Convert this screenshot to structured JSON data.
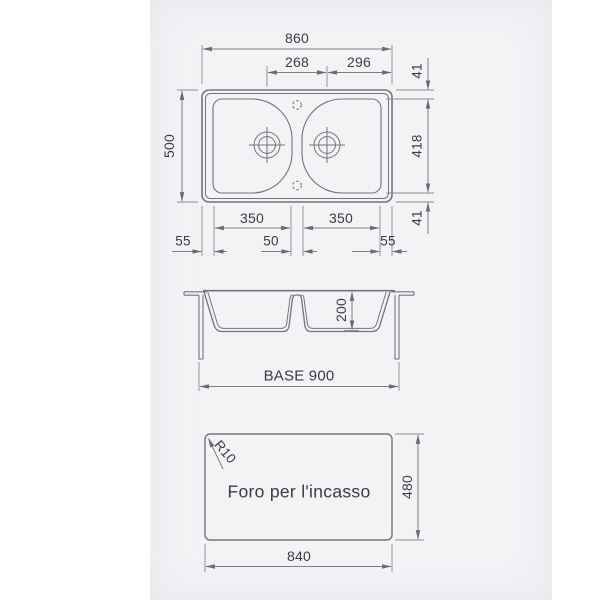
{
  "top_view": {
    "overall_width": "860",
    "drain_spacing": "268",
    "drain_to_edge": "296",
    "overall_depth": "500",
    "rim_top": "41",
    "bowl_span": "418",
    "rim_bottom": "41",
    "bowl_left_width": "350",
    "bowl_right_width": "350",
    "left_margin": "55",
    "center_gap": "50",
    "right_margin": "55"
  },
  "section_view": {
    "bowl_depth": "200",
    "base_label": "BASE 900"
  },
  "cutout_view": {
    "corner_radius": "R10",
    "caption": "Foro per l'incasso",
    "cut_width": "840",
    "cut_height": "480"
  },
  "colors": {
    "paper": "#f2f3f5",
    "margin": "#ffffff",
    "line": "#7e7e85",
    "text": "#3b3b41"
  }
}
